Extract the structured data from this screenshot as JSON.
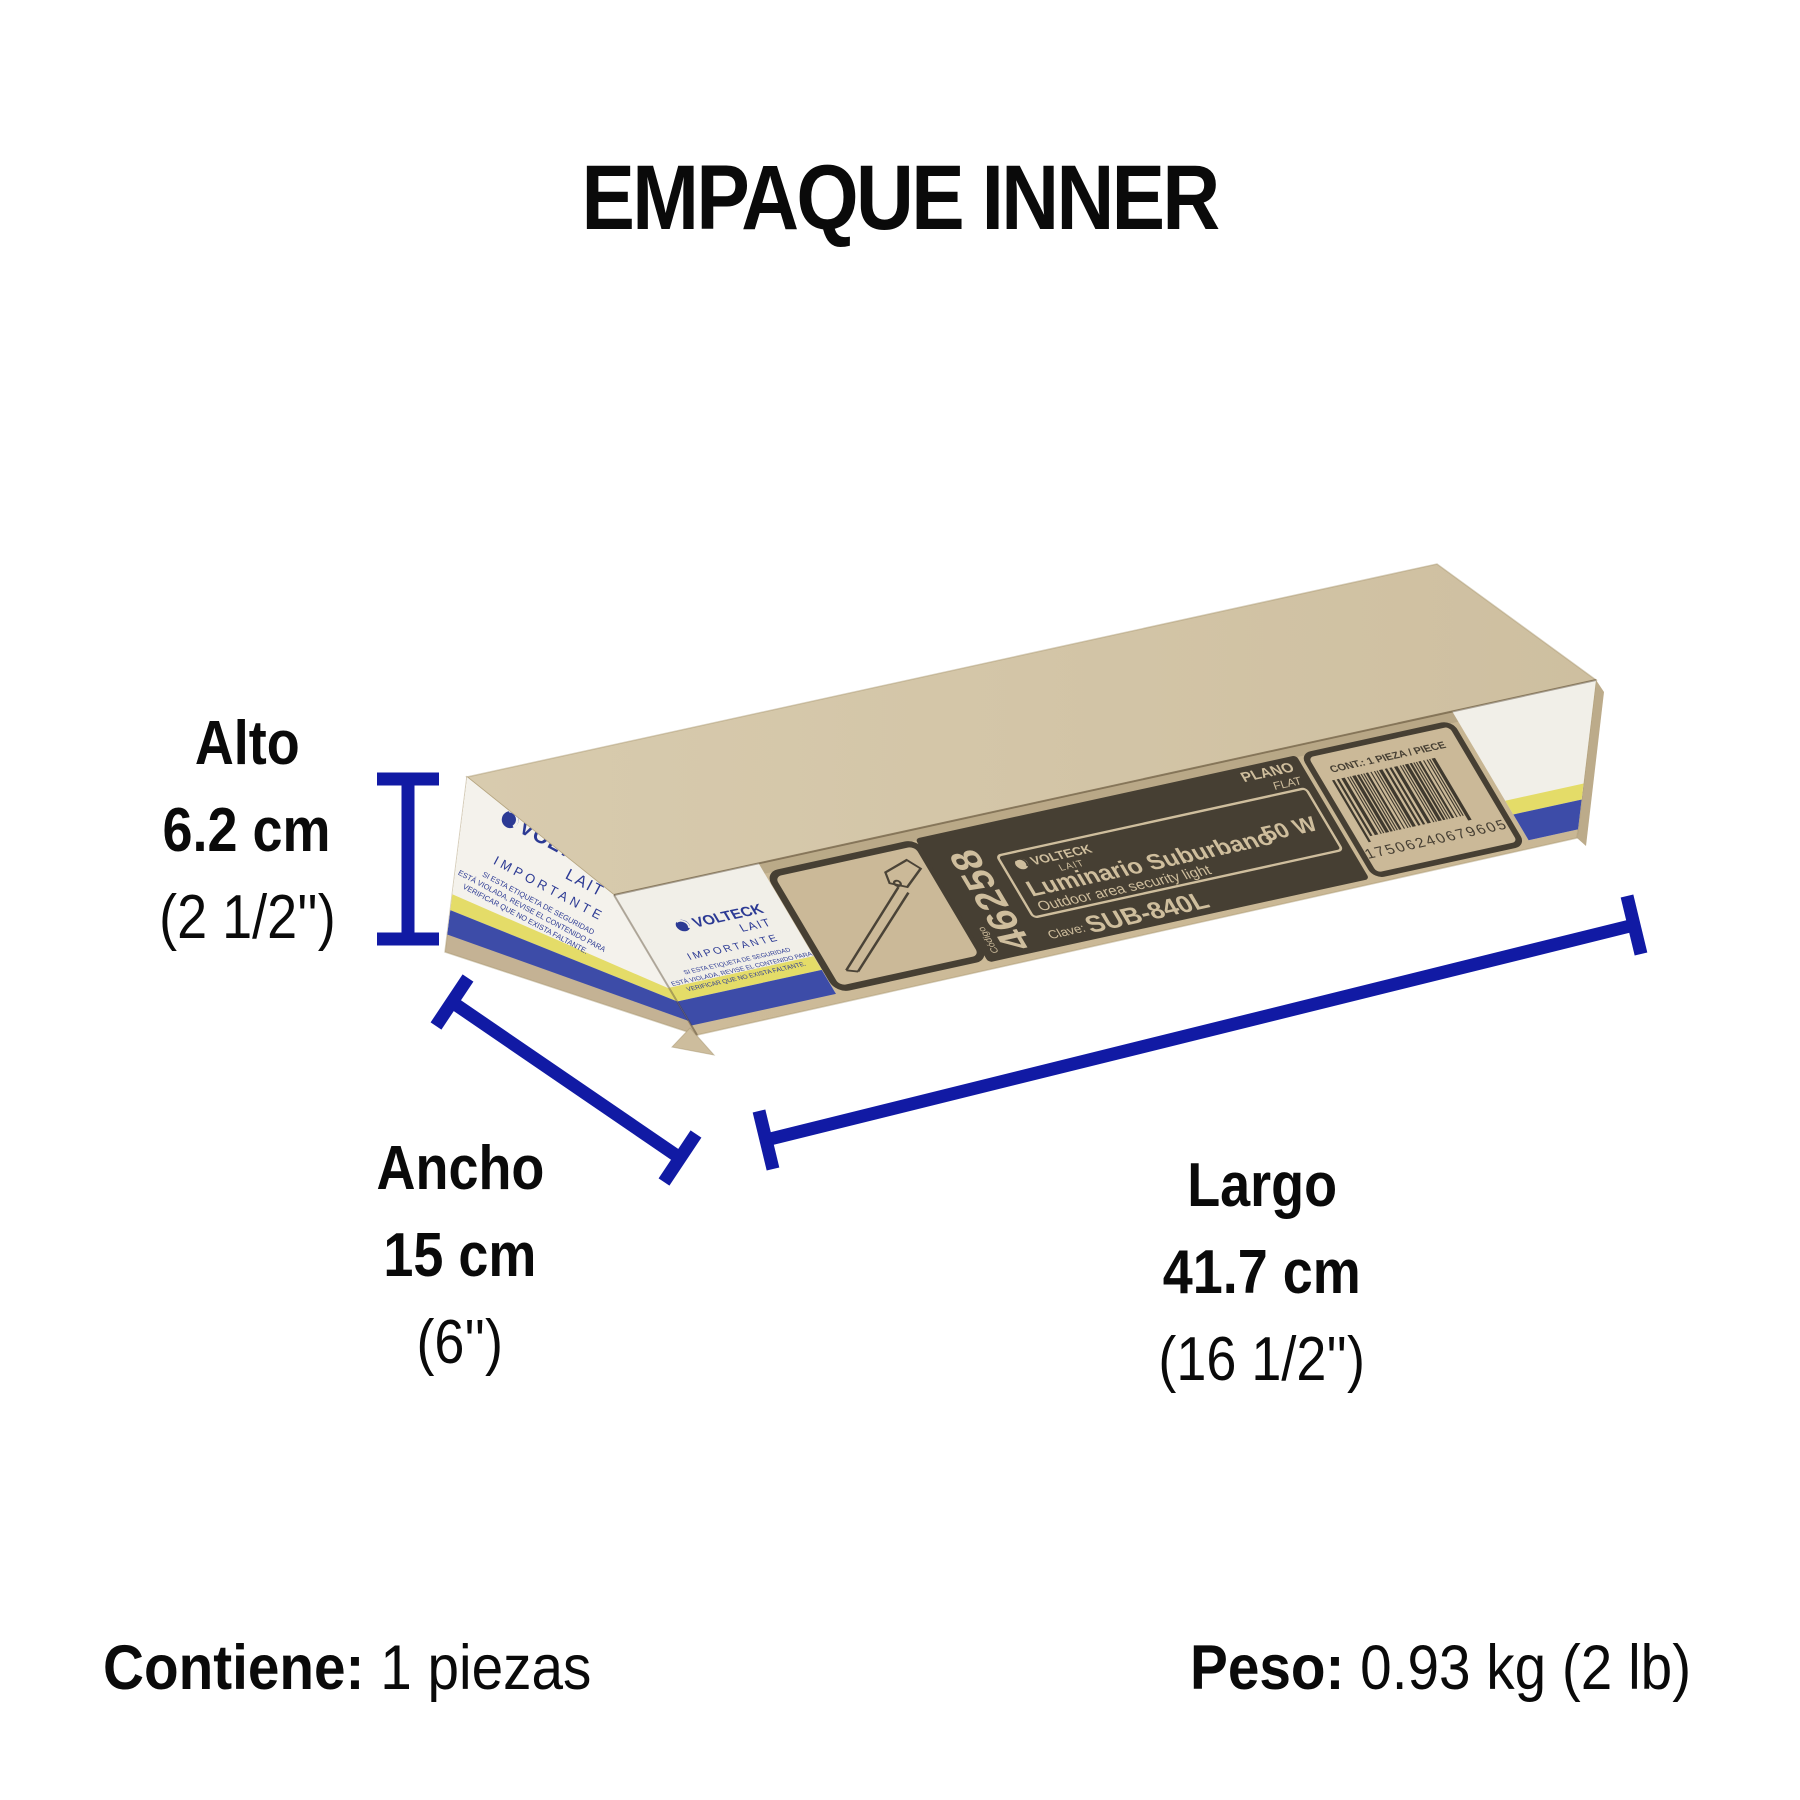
{
  "title": "EMPAQUE INNER",
  "dimensions": {
    "alto": {
      "label": "Alto",
      "value": "6.2 cm",
      "inches": "(2 1/2'')"
    },
    "ancho": {
      "label": "Ancho",
      "value": "15 cm",
      "inches": "(6'')"
    },
    "largo": {
      "label": "Largo",
      "value": "41.7 cm",
      "inches": "(16 1/2'')"
    }
  },
  "footer": {
    "contains_label": "Contiene:",
    "contains_value": " 1 piezas",
    "weight_label": "Peso:",
    "weight_value": " 0.93 kg (2 lb)"
  },
  "box": {
    "tape": {
      "brand": "VOLTECK",
      "sub_brand": "LAIT",
      "importante": "IMPORTANTE",
      "notice_line1": "SI ESTA ETIQUETA DE SEGURIDAD",
      "notice_line2": "ESTÁ VIOLADA, REVISE EL CONTENIDO PARA",
      "notice_line3": "VERIFICAR QUE NO EXISTA FALTANTE."
    },
    "panel": {
      "codigo_label": "Código",
      "codigo": "46258",
      "brand": "VOLTECK",
      "sub_brand": "LAIT",
      "product_es": "Luminario Suburbano",
      "product_en": "Outdoor area security light",
      "watts": "50 W",
      "clave_label": "Clave:",
      "clave": "SUB-840L",
      "plano": "PLANO",
      "flat": "FLAT",
      "cont": "CONT.: 1 PIEZA / PIECE",
      "barcode": "17506240679605"
    }
  },
  "colors": {
    "dimension_line": "#111AA4",
    "cardboard_top": "#d5c7a9",
    "cardboard_front": "#c9b795",
    "panel_dark": "#463f33",
    "panel_text": "#cfbe9d",
    "tape_white": "#f4f2ec",
    "tape_blue_text": "#2c3a94",
    "stripe_yellow": "#e4dc68",
    "stripe_blue": "#3d4ca8"
  }
}
